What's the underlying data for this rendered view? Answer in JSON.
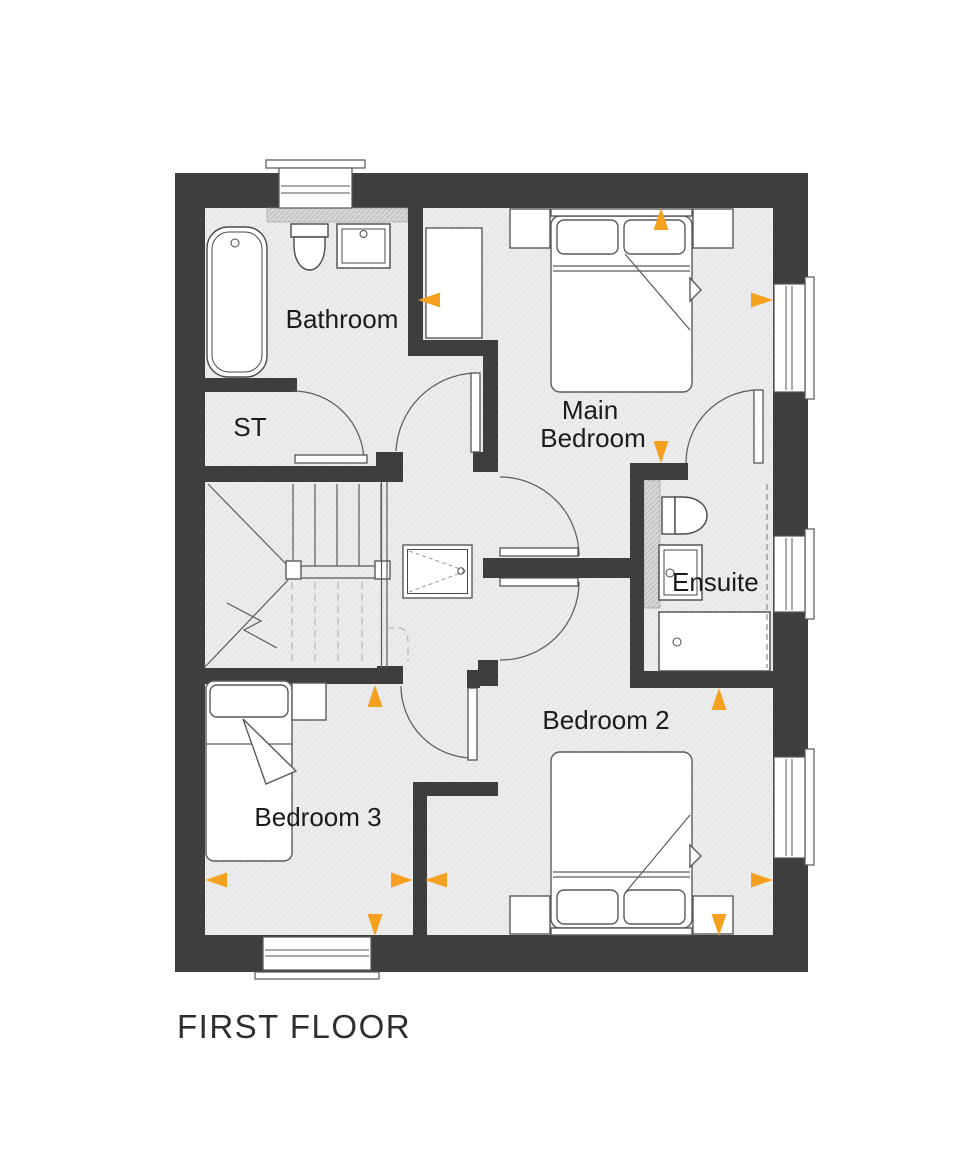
{
  "title": "FIRST FLOOR",
  "colors": {
    "wall": "#3E3E3E",
    "floor": "#ECECEC",
    "line": "#4A4A4A",
    "marker_orange": "#F5A01E"
  },
  "rooms": {
    "bathroom": {
      "label": "Bathroom",
      "fixtures": [
        "bath",
        "toilet",
        "basin"
      ]
    },
    "storage": {
      "label": "ST",
      "fixtures": []
    },
    "main_bedroom": {
      "label_line1": "Main",
      "label_line2": "Bedroom",
      "fixtures": [
        "double-bed",
        "wardrobe",
        "bedside-table",
        "bedside-table"
      ]
    },
    "ensuite": {
      "label": "Ensuite",
      "fixtures": [
        "toilet",
        "basin",
        "shower"
      ]
    },
    "bedroom_2": {
      "label": "Bedroom 2",
      "fixtures": [
        "double-bed",
        "bedside-table",
        "bedside-table"
      ]
    },
    "bedroom_3": {
      "label": "Bedroom 3",
      "fixtures": [
        "single-bed",
        "bedside-table"
      ]
    },
    "landing": {
      "fixtures": [
        "staircase",
        "hatch-cupboard"
      ]
    }
  },
  "markers": {
    "color": "#F5A01E",
    "items": [
      {
        "dir": "left",
        "x": 429,
        "y": 300
      },
      {
        "dir": "up",
        "x": 661,
        "y": 219
      },
      {
        "dir": "right",
        "x": 762,
        "y": 300
      },
      {
        "dir": "down",
        "x": 661,
        "y": 452
      },
      {
        "dir": "up",
        "x": 719,
        "y": 699
      },
      {
        "dir": "up",
        "x": 375,
        "y": 696
      },
      {
        "dir": "left",
        "x": 216,
        "y": 880
      },
      {
        "dir": "right",
        "x": 402,
        "y": 880
      },
      {
        "dir": "left",
        "x": 436,
        "y": 880
      },
      {
        "dir": "right",
        "x": 762,
        "y": 880
      },
      {
        "dir": "down",
        "x": 375,
        "y": 925
      },
      {
        "dir": "down",
        "x": 719,
        "y": 925
      }
    ]
  }
}
